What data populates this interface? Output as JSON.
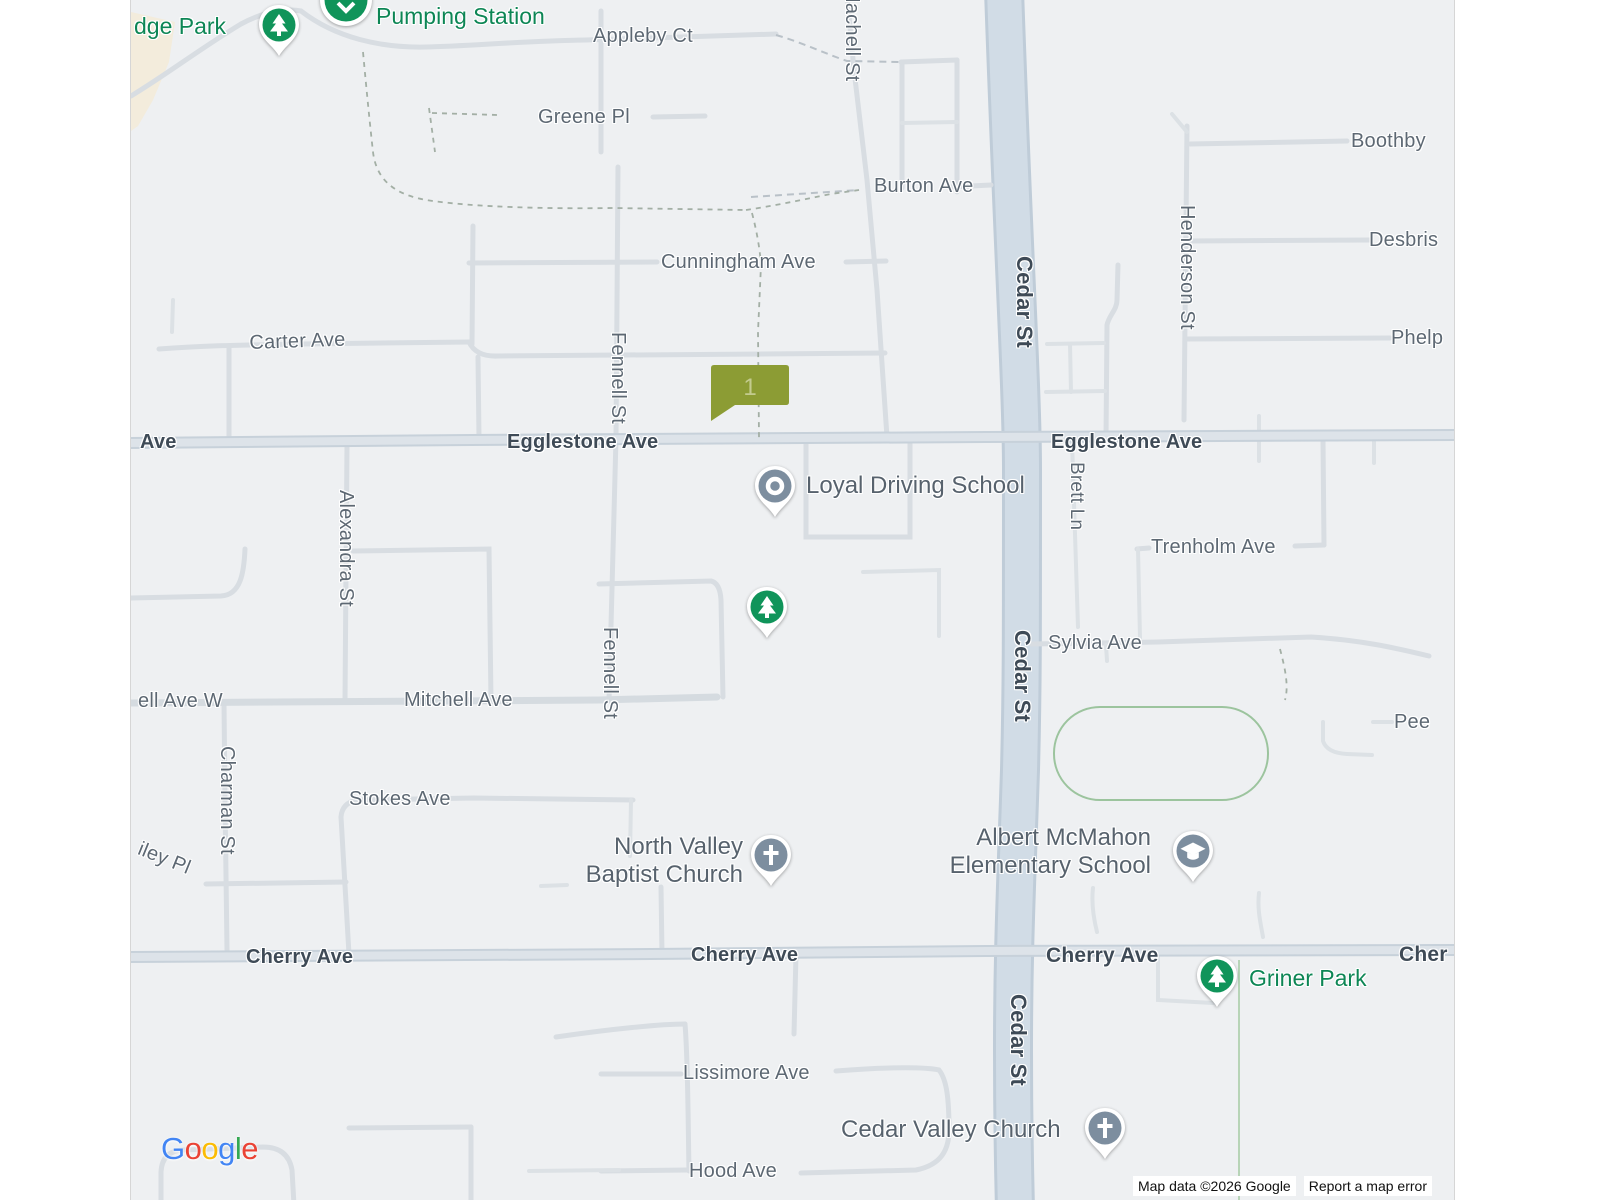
{
  "map_type": "google-road-map",
  "colors": {
    "background": "#eef0f2",
    "road_minor": "#d8dde2",
    "road_major_core": "#dde3e9",
    "road_major_casing": "#c7d1da",
    "cedar_core": "#d1dce6",
    "cedar_casing": "#bfccd8",
    "park_outline": "#9cc49e",
    "street_label": "#5d6873",
    "street_label_major": "#3e4a56",
    "poi_label": "#57626d",
    "park_label": "#0d8655",
    "pin_green": "#10945a",
    "pin_slate": "#7d8e9f",
    "marker_fill": "#8c9c34",
    "marker_text": "#c3cb8e"
  },
  "marker": {
    "label": "1",
    "x": 709,
    "y": 365,
    "width": 81,
    "height": 39
  },
  "street_labels": [
    {
      "text": "Appleby Ct",
      "x": 592,
      "y": 25
    },
    {
      "text": "Greene Pl",
      "x": 537,
      "y": 106
    },
    {
      "text": "Machell St",
      "x": 862,
      "y": -14,
      "rot": 90
    },
    {
      "text": "Burton Ave",
      "x": 873,
      "y": 175
    },
    {
      "text": "Cunningham Ave",
      "x": 660,
      "y": 251
    },
    {
      "text": "Carter Ave",
      "x": 248,
      "y": 332,
      "rot": -2
    },
    {
      "text": "Ave",
      "x": 139,
      "y": 431,
      "bold": true
    },
    {
      "text": "Egglestone Ave",
      "x": 506,
      "y": 431,
      "bold": true
    },
    {
      "text": "Egglestone Ave",
      "x": 1050,
      "y": 431,
      "bold": true
    },
    {
      "text": "Fennell St",
      "x": 628,
      "y": 332,
      "rot": 90
    },
    {
      "text": "Fennell St",
      "x": 620,
      "y": 627,
      "rot": 90
    },
    {
      "text": "Alexandra St",
      "x": 356,
      "y": 490,
      "rot": 90
    },
    {
      "text": "Cedar St",
      "x": 1036,
      "y": 256,
      "rot": 90,
      "bold": true,
      "size": 22
    },
    {
      "text": "Cedar St",
      "x": 1034,
      "y": 630,
      "rot": 90,
      "bold": true,
      "size": 22
    },
    {
      "text": "Cedar St",
      "x": 1030,
      "y": 994,
      "rot": 90,
      "bold": true,
      "size": 22
    },
    {
      "text": "Brett Ln",
      "x": 1086,
      "y": 462,
      "rot": 90,
      "size": 19
    },
    {
      "text": "Henderson St",
      "x": 1197,
      "y": 205,
      "rot": 90
    },
    {
      "text": "Boothby",
      "x": 1350,
      "y": 130
    },
    {
      "text": "Desbris",
      "x": 1368,
      "y": 229
    },
    {
      "text": "Phelp",
      "x": 1390,
      "y": 327
    },
    {
      "text": "Trenholm Ave",
      "x": 1150,
      "y": 536
    },
    {
      "text": "Sylvia Ave",
      "x": 1047,
      "y": 632
    },
    {
      "text": "Pee",
      "x": 1393,
      "y": 711
    },
    {
      "text": "ell Ave W",
      "x": 137,
      "y": 690
    },
    {
      "text": "Mitchell Ave",
      "x": 403,
      "y": 689
    },
    {
      "text": "Charman St",
      "x": 237,
      "y": 746,
      "rot": 90
    },
    {
      "text": "iley Pl",
      "x": 142,
      "y": 838,
      "rot": 22
    },
    {
      "text": "Stokes Ave",
      "x": 348,
      "y": 788
    },
    {
      "text": "Cherry Ave",
      "x": 245,
      "y": 946,
      "bold": true
    },
    {
      "text": "Cherry Ave",
      "x": 690,
      "y": 944,
      "bold": true
    },
    {
      "text": "Cherry Ave",
      "x": 1045,
      "y": 944,
      "bold": true,
      "size": 21
    },
    {
      "text": "Cher",
      "x": 1398,
      "y": 943,
      "bold": true,
      "size": 21
    },
    {
      "text": "Lissimore Ave",
      "x": 682,
      "y": 1062
    },
    {
      "text": "Hood Ave",
      "x": 688,
      "y": 1160
    }
  ],
  "poi_labels": [
    {
      "id": "edge-park",
      "lines": [
        "dge Park"
      ],
      "x": 133,
      "y": 12,
      "size": 23,
      "kind": "park",
      "align": "left"
    },
    {
      "id": "pumping-station",
      "lines": [
        "Pumping Station"
      ],
      "x": 375,
      "y": 2,
      "size": 23,
      "kind": "park",
      "align": "left"
    },
    {
      "id": "loyal-driving-school",
      "lines": [
        "Loyal Driving School"
      ],
      "x": 805,
      "y": 472,
      "size": 24,
      "kind": "poi",
      "align": "left"
    },
    {
      "id": "north-valley-baptist-church",
      "lines": [
        "North Valley",
        "Baptist Church"
      ],
      "x": 742,
      "y": 833,
      "size": 24,
      "kind": "poi",
      "align": "right"
    },
    {
      "id": "albert-mcmahon-elementary-school",
      "lines": [
        "Albert McMahon",
        "Elementary School"
      ],
      "x": 1150,
      "y": 824,
      "size": 24,
      "kind": "poi",
      "align": "right"
    },
    {
      "id": "griner-park",
      "lines": [
        "Griner Park"
      ],
      "x": 1248,
      "y": 964,
      "size": 23,
      "kind": "park",
      "align": "left"
    },
    {
      "id": "cedar-valley-church",
      "lines": [
        "Cedar Valley Church"
      ],
      "x": 840,
      "y": 1116,
      "size": 24,
      "kind": "poi",
      "align": "left"
    }
  ],
  "pins": [
    {
      "type": "park",
      "name": "edge-park-pin",
      "x": 278,
      "y": 25
    },
    {
      "type": "pumping",
      "name": "pumping-station-pin",
      "x": 345,
      "y": 0
    },
    {
      "type": "dot",
      "name": "loyal-driving-school-pin",
      "x": 774,
      "y": 486
    },
    {
      "type": "park",
      "name": "park-pin",
      "x": 766,
      "y": 607
    },
    {
      "type": "church",
      "name": "north-valley-baptist-church-pin",
      "x": 770,
      "y": 855
    },
    {
      "type": "school",
      "name": "albert-mcmahon-school-pin",
      "x": 1192,
      "y": 851
    },
    {
      "type": "park",
      "name": "griner-park-pin",
      "x": 1216,
      "y": 976
    },
    {
      "type": "church",
      "name": "cedar-valley-church-pin",
      "x": 1104,
      "y": 1128
    }
  ],
  "attribution": {
    "map_data": "Map data ©2026 Google",
    "report_error": "Report a map error"
  },
  "logo_letters": [
    {
      "ch": "G",
      "c": "#4285F4"
    },
    {
      "ch": "o",
      "c": "#EA4335"
    },
    {
      "ch": "o",
      "c": "#FBBC05"
    },
    {
      "ch": "g",
      "c": "#4285F4"
    },
    {
      "ch": "l",
      "c": "#34A853"
    },
    {
      "ch": "e",
      "c": "#EA4335"
    }
  ]
}
